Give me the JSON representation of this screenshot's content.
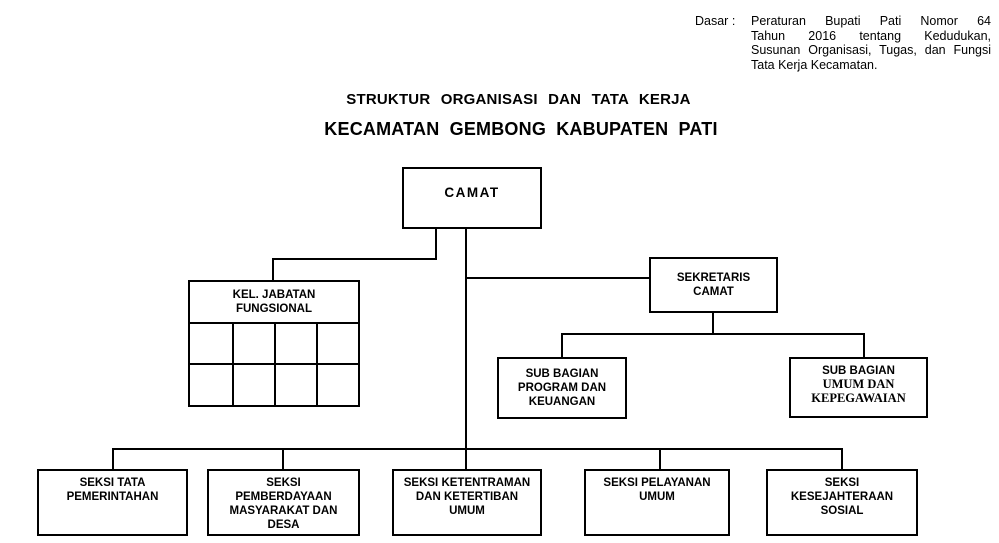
{
  "meta": {
    "background": "#ffffff",
    "ink": "#000000"
  },
  "legal_note": {
    "label": "Dasar :",
    "lines": [
      "Peraturan Bupati Pati Nomor 64",
      "Tahun 2016 tentang Kedudukan,",
      "Susunan Organisasi, Tugas, dan Fungsi",
      "Tata Kerja Kecamatan."
    ]
  },
  "title": {
    "line1": "STRUKTUR ORGANISASI DAN TATA KERJA",
    "line2": "KECAMATAN GEMBONG KABUPATEN PATI"
  },
  "org": {
    "camat": {
      "label": "CAMAT"
    },
    "kel_jabatan_fungsional": {
      "label": "KEL. JABATAN\nFUNGSIONAL",
      "grid_rows": 2,
      "grid_cols": 4
    },
    "sekretaris_camat": {
      "label": "SEKRETARIS\nCAMAT"
    },
    "sub_bagian_program": {
      "label": "SUB BAGIAN\nPROGRAM DAN\nKEUANGAN"
    },
    "sub_bagian_umum": {
      "label_line1": "SUB BAGIAN",
      "label_rest": "UMUM DAN\nKEPEGAWAIAN"
    },
    "seksi": [
      {
        "label": "SEKSI TATA\nPEMERINTAHAN"
      },
      {
        "label": "SEKSI\nPEMBERDAYAAN\nMASYARAKAT DAN\nDESA"
      },
      {
        "label": "SEKSI KETENTRAMAN\nDAN KETERTIBAN\nUMUM"
      },
      {
        "label": "SEKSI PELAYANAN\nUMUM"
      },
      {
        "label": "SEKSI\nKESEJAHTERAAN\nSOSIAL"
      }
    ]
  }
}
